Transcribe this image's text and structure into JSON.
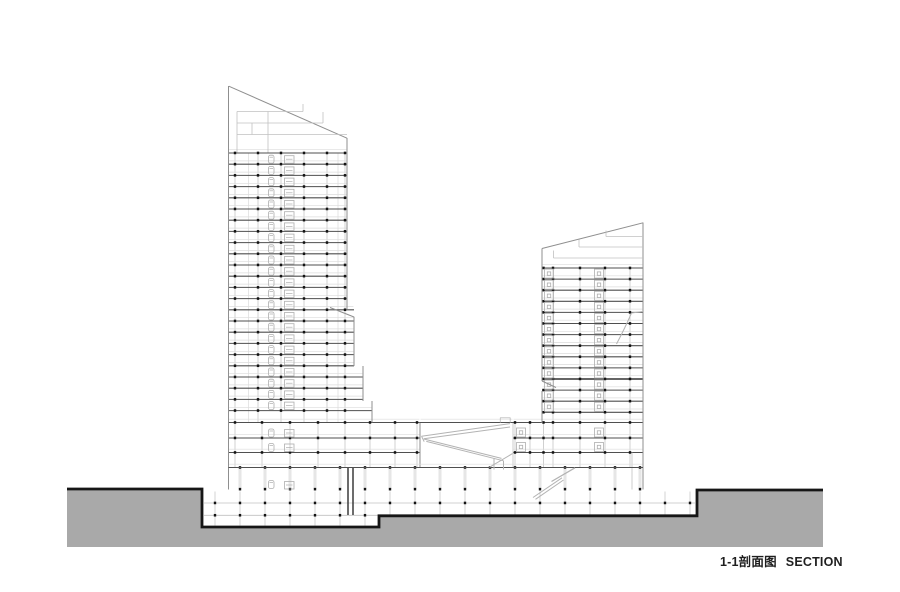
{
  "footer": {
    "label_cn": "1-1剖面图",
    "label_en": "SECTION"
  },
  "drawing": {
    "canvas": {
      "w": 900,
      "h": 592
    },
    "colors": {
      "paper": "#ffffff",
      "ground": "#a9a9a9",
      "outline": "#161616",
      "slab": "#4f4f4f",
      "edge": "#8f8f8f",
      "light": "#dcdcdc",
      "mid": "#c0c0c0",
      "fixture": "#aeaeae",
      "tick": "#141414",
      "ramp": "#b3b3b3",
      "core": "#3a3a3a",
      "text": "#1f1f1f"
    },
    "ground": {
      "fill_path": "M67,489 H202 V527 H379 V515.8 H697 V490 H823 V547 H67 Z",
      "outline_path": "M67,489 H202 V527 H379 V515.8 H697 V490 H823"
    },
    "basement": {
      "slabs": [
        {
          "y": 503,
          "x1": 204,
          "x2": 695
        },
        {
          "y": 515.3,
          "x1": 204,
          "x2": 378
        }
      ],
      "col_from": 215,
      "col_to": 691,
      "col_step": 25,
      "col_top": 491.5,
      "deep_until": 378,
      "col_bot_deep": 525.5,
      "col_bot": 514.5
    },
    "towers": [
      {
        "name": "left-tower",
        "slab_start": 153,
        "slab_step": 11.2,
        "slab_count": 24,
        "extents": [
          {
            "until": 309,
            "x1": 228.5,
            "x2": 347
          },
          {
            "until": 366,
            "x1": 228.5,
            "x2": 354
          },
          {
            "until": 401,
            "x1": 228.5,
            "x2": 363
          },
          {
            "until": 9999,
            "x1": 228.5,
            "x2": 372
          }
        ],
        "columns": [
          235,
          258,
          281,
          304,
          327,
          345
        ],
        "col_top": 153,
        "col_bottom": 422.5,
        "cores": [
          248.5,
          338
        ],
        "thick": [],
        "fixtures": [
          {
            "k": "toilet",
            "x": 268.5
          },
          {
            "k": "basin",
            "x": 284.5
          }
        ]
      },
      {
        "name": "right-tower",
        "slab_start": 268,
        "slab_step": 11.1,
        "slab_count": 14,
        "extents": [
          {
            "until": 9999,
            "x1": 542,
            "x2": 643
          }
        ],
        "columns": [
          553,
          580,
          605,
          630
        ],
        "tick_cols": [
          543.5,
          553,
          580,
          605,
          630
        ],
        "col_top": 268,
        "col_bottom": 422.5,
        "cores": [],
        "thick": [
          10
        ],
        "fixtures": [
          {
            "k": "sq",
            "x": 544.5
          },
          {
            "k": "sq",
            "x": 594.5
          }
        ]
      }
    ],
    "podiums": [
      {
        "name": "podium-left",
        "slabs": [
          422.5,
          438,
          452.5
        ],
        "x1": 228.5,
        "x2": 420,
        "columns": [
          235,
          262,
          290,
          318,
          345,
          370,
          395,
          417
        ],
        "col_top": 423,
        "col_bottom": 467,
        "fixtures": [
          {
            "k": "toilet",
            "x": 268.5
          },
          {
            "k": "basin",
            "x": 284.5
          }
        ]
      },
      {
        "name": "podium-right",
        "slabs": [
          422.5,
          438,
          452.5
        ],
        "x1": 513,
        "x2": 643,
        "columns": [
          515,
          530,
          543.5,
          553,
          580,
          605,
          630
        ],
        "col_top": 423,
        "col_bottom": 467,
        "fixtures": [
          {
            "k": "sq",
            "x": 516.5
          },
          {
            "k": "sq",
            "x": 594.5
          }
        ]
      }
    ],
    "ground_floor": {
      "col_from": 240,
      "col_to": 641,
      "col_step": 25,
      "top": 468.3,
      "bottom": 489,
      "tick_top_y": 467.5,
      "tick_bot_y": 489.2
    },
    "ops": [
      {
        "t": "l",
        "x1": 228.5,
        "y1": 86,
        "x2": 228.5,
        "y2": 489.5,
        "c": "edge",
        "w": 1
      },
      {
        "t": "l",
        "x1": 228.8,
        "y1": 86.2,
        "x2": 347,
        "y2": 138.2,
        "c": "edge",
        "w": 1
      },
      {
        "t": "l",
        "x1": 347,
        "y1": 138,
        "x2": 347,
        "y2": 309,
        "c": "edge",
        "w": 1
      },
      {
        "t": "l",
        "x1": 330,
        "y1": 307.5,
        "x2": 354,
        "y2": 317,
        "c": "edge",
        "w": 1
      },
      {
        "t": "l",
        "x1": 354,
        "y1": 316.8,
        "x2": 354,
        "y2": 366,
        "c": "edge",
        "w": 1
      },
      {
        "t": "l",
        "x1": 363,
        "y1": 366,
        "x2": 363,
        "y2": 401,
        "c": "edge",
        "w": 1
      },
      {
        "t": "l",
        "x1": 372,
        "y1": 401,
        "x2": 372,
        "y2": 422.5,
        "c": "edge",
        "w": 1
      },
      {
        "t": "l",
        "x1": 420,
        "y1": 422.5,
        "x2": 420,
        "y2": 467.5,
        "c": "edge",
        "w": 1
      },
      {
        "t": "l",
        "x1": 237,
        "y1": 111.5,
        "x2": 303,
        "y2": 111.5,
        "c": "mid",
        "w": 0.8
      },
      {
        "t": "l",
        "x1": 237,
        "y1": 123,
        "x2": 323,
        "y2": 123,
        "c": "mid",
        "w": 0.8
      },
      {
        "t": "l",
        "x1": 237,
        "y1": 134.5,
        "x2": 347,
        "y2": 134.5,
        "c": "mid",
        "w": 0.8
      },
      {
        "t": "l",
        "x1": 237,
        "y1": 111.5,
        "x2": 237,
        "y2": 152.5,
        "c": "mid",
        "w": 0.8
      },
      {
        "t": "l",
        "x1": 268,
        "y1": 111.5,
        "x2": 268,
        "y2": 152.5,
        "c": "mid",
        "w": 0.8
      },
      {
        "t": "l",
        "x1": 303,
        "y1": 104,
        "x2": 303,
        "y2": 111.5,
        "c": "mid",
        "w": 0.8
      },
      {
        "t": "l",
        "x1": 323,
        "y1": 112,
        "x2": 323,
        "y2": 123,
        "c": "mid",
        "w": 0.8
      },
      {
        "t": "l",
        "x1": 252,
        "y1": 123,
        "x2": 252,
        "y2": 134.5,
        "c": "mid",
        "w": 0.8
      },
      {
        "t": "l",
        "x1": 643,
        "y1": 222.5,
        "x2": 643,
        "y2": 489.5,
        "c": "edge",
        "w": 1
      },
      {
        "t": "l",
        "x1": 542,
        "y1": 248.5,
        "x2": 643,
        "y2": 222.8,
        "c": "edge",
        "w": 1
      },
      {
        "t": "l",
        "x1": 542,
        "y1": 248.5,
        "x2": 542,
        "y2": 381,
        "c": "edge",
        "w": 1
      },
      {
        "t": "l",
        "x1": 542,
        "y1": 391,
        "x2": 542,
        "y2": 423,
        "c": "edge",
        "w": 1
      },
      {
        "t": "l",
        "x1": 542,
        "y1": 381,
        "x2": 556,
        "y2": 387.5,
        "c": "edge",
        "w": 1.1
      },
      {
        "t": "l",
        "x1": 606,
        "y1": 236.5,
        "x2": 643,
        "y2": 236.5,
        "c": "mid",
        "w": 0.8
      },
      {
        "t": "l",
        "x1": 579,
        "y1": 247,
        "x2": 643,
        "y2": 247,
        "c": "mid",
        "w": 0.8
      },
      {
        "t": "l",
        "x1": 553.5,
        "y1": 258,
        "x2": 643,
        "y2": 258,
        "c": "mid",
        "w": 0.8
      },
      {
        "t": "l",
        "x1": 606,
        "y1": 230.5,
        "x2": 606,
        "y2": 236.5,
        "c": "mid",
        "w": 0.8
      },
      {
        "t": "l",
        "x1": 579,
        "y1": 239.5,
        "x2": 579,
        "y2": 247,
        "c": "mid",
        "w": 0.8
      },
      {
        "t": "l",
        "x1": 553.5,
        "y1": 250.5,
        "x2": 553.5,
        "y2": 258,
        "c": "mid",
        "w": 0.8
      },
      {
        "t": "l",
        "x1": 513,
        "y1": 423,
        "x2": 513,
        "y2": 467.5,
        "c": "mid",
        "w": 0.8
      },
      {
        "t": "l",
        "x1": 632,
        "y1": 452.5,
        "x2": 632,
        "y2": 489.5,
        "c": "mid",
        "w": 0.8
      },
      {
        "t": "p",
        "d": "M616.5,344 Q625,328 631.5,313 L643,311.5",
        "c": "ramp",
        "w": 1
      },
      {
        "t": "slab",
        "y": 422.5,
        "x1": 420,
        "x2": 513
      },
      {
        "t": "slab",
        "y": 467.5,
        "x1": 228.5,
        "x2": 643
      },
      {
        "t": "l",
        "x1": 500,
        "y1": 417.8,
        "x2": 510.5,
        "y2": 417.8,
        "c": "mid",
        "w": 0.9
      },
      {
        "t": "l",
        "x1": 500.3,
        "y1": 417.8,
        "x2": 500.3,
        "y2": 422.5,
        "c": "mid",
        "w": 0.9
      },
      {
        "t": "l",
        "x1": 510.2,
        "y1": 417.8,
        "x2": 510.2,
        "y2": 422.5,
        "c": "mid",
        "w": 0.9
      },
      {
        "t": "l",
        "x1": 510,
        "y1": 423.6,
        "x2": 421.5,
        "y2": 436.2,
        "c": "ramp",
        "w": 1
      },
      {
        "t": "l",
        "x1": 510,
        "y1": 427,
        "x2": 423.8,
        "y2": 438.8,
        "c": "ramp",
        "w": 1
      },
      {
        "t": "l",
        "x1": 421.5,
        "y1": 436.2,
        "x2": 424.2,
        "y2": 441.6,
        "c": "ramp",
        "w": 1
      },
      {
        "t": "l",
        "x1": 423.8,
        "y1": 439,
        "x2": 501.5,
        "y2": 458.4,
        "c": "ramp",
        "w": 1
      },
      {
        "t": "l",
        "x1": 426.3,
        "y1": 441.4,
        "x2": 503.5,
        "y2": 460.8,
        "c": "ramp",
        "w": 1
      },
      {
        "t": "l",
        "x1": 494,
        "y1": 458.5,
        "x2": 494,
        "y2": 469.5,
        "c": "ramp",
        "w": 1
      },
      {
        "t": "l",
        "x1": 503.5,
        "y1": 460.8,
        "x2": 503.5,
        "y2": 469.5,
        "c": "ramp",
        "w": 1
      },
      {
        "t": "l",
        "x1": 489.5,
        "y1": 467.2,
        "x2": 512.5,
        "y2": 453.6,
        "c": "ramp",
        "w": 1
      },
      {
        "t": "l",
        "x1": 533,
        "y1": 497.5,
        "x2": 562,
        "y2": 477.8,
        "c": "ramp",
        "w": 1
      },
      {
        "t": "l",
        "x1": 535.5,
        "y1": 499.3,
        "x2": 563.5,
        "y2": 480,
        "c": "ramp",
        "w": 1
      },
      {
        "t": "l",
        "x1": 551.5,
        "y1": 481.5,
        "x2": 575,
        "y2": 467.8,
        "c": "ramp",
        "w": 1.3
      },
      {
        "t": "l",
        "x1": 348,
        "y1": 468,
        "x2": 348,
        "y2": 515,
        "c": "core",
        "w": 1.5
      },
      {
        "t": "l",
        "x1": 353,
        "y1": 468,
        "x2": 353,
        "y2": 515,
        "c": "core",
        "w": 1.5
      },
      {
        "t": "fx",
        "k": "toilet",
        "x": 268.5,
        "y": 478.5
      },
      {
        "t": "fx",
        "k": "basin",
        "x": 284.5,
        "y": 479
      }
    ]
  }
}
